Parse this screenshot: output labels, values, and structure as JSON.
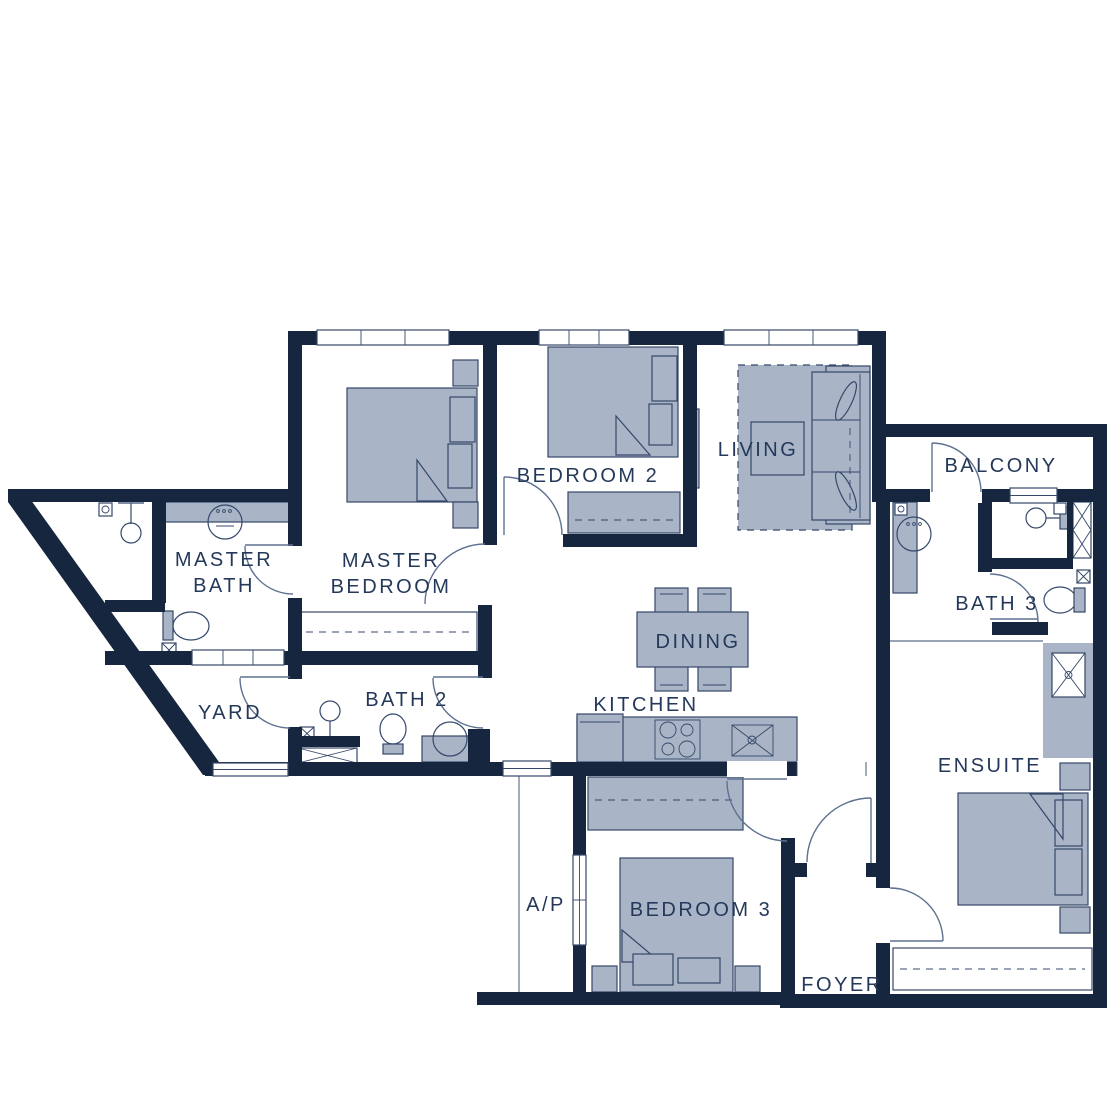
{
  "title": "3-bedroom apartment floor plan",
  "colors": {
    "wall": "#16263e",
    "furniture": "#a9b5c6",
    "outline": "#35486a",
    "label": "#24395a",
    "door": "#5f7190",
    "background": "#ffffff"
  },
  "labels": {
    "master_bath_line1": "MASTER",
    "master_bath_line2": "BATH",
    "master_bedroom_line1": "MASTER",
    "master_bedroom_line2": "BEDROOM",
    "bedroom2": "BEDROOM 2",
    "living": "LIVING",
    "balcony": "BALCONY",
    "bath3": "BATH 3",
    "dining": "DINING",
    "kitchen": "KITCHEN",
    "yard": "YARD",
    "bath2": "BATH 2",
    "ap": "A/P",
    "bedroom3": "BEDROOM 3",
    "ensuite": "ENSUITE",
    "foyer": "FOYER"
  }
}
